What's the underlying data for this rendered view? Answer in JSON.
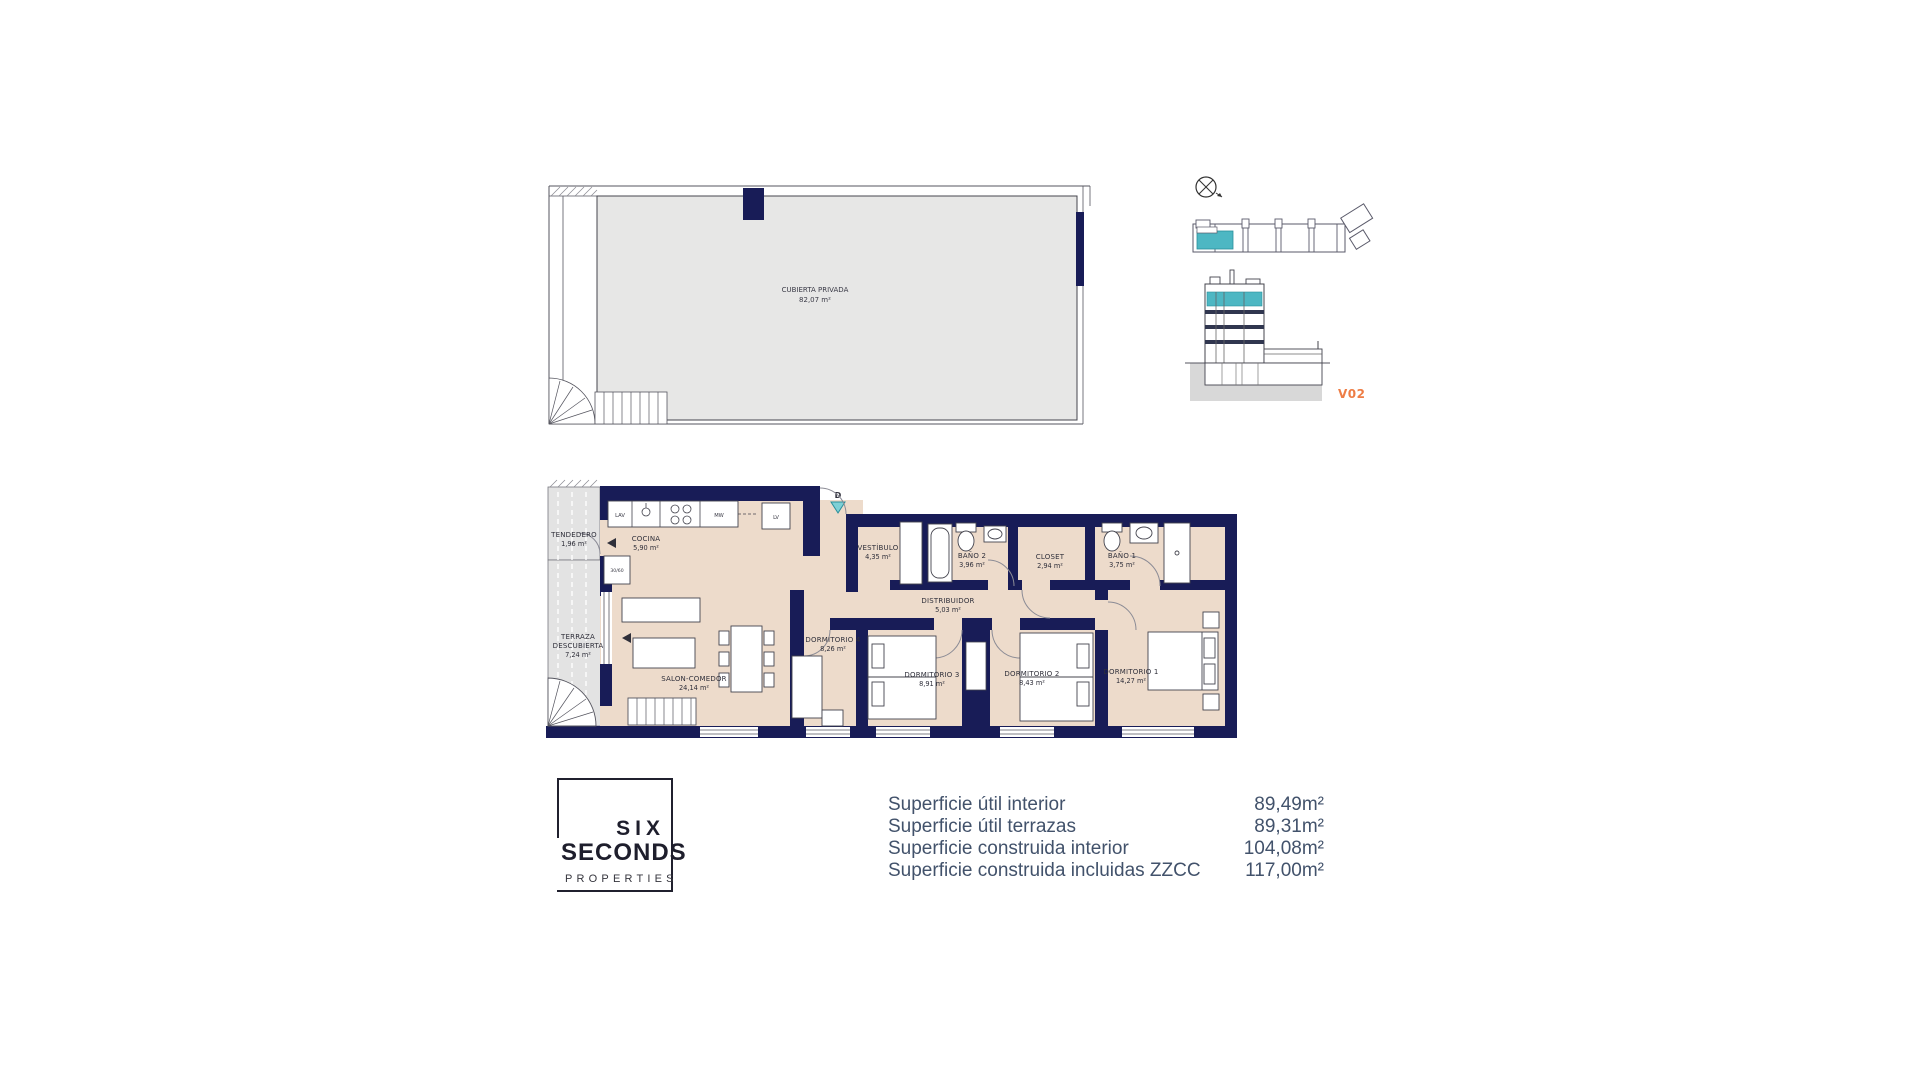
{
  "colors": {
    "wall_navy": "#181c57",
    "floor_beige": "#eddbcb",
    "terrace_gray": "#e3e3e3",
    "roof_gray": "#e7e7e6",
    "accent_teal": "#4db7c3",
    "accent_teal_light": "#7ed0d6",
    "accent_orange": "#ee7d45",
    "table_text": "#42526b",
    "plan_text": "#2f2f3a"
  },
  "roof_plan": {
    "label": "CUBIERTA PRIVADA",
    "area": "82,07 m²"
  },
  "locator": {
    "unit_label": "V02"
  },
  "floor_plan": {
    "entrance_marker": "D",
    "column_label": "30/60",
    "kitchen_appliances": [
      {
        "label": "LAV"
      },
      {
        "label": "MW"
      },
      {
        "label": "LV"
      }
    ],
    "rooms": [
      {
        "name": "TENDEDERO",
        "area": "1,96 m²"
      },
      {
        "name": "COCINA",
        "area": "5,90 m²"
      },
      {
        "name": "TERRAZA",
        "name2": "DESCUBIERTA",
        "area": "7,24 m²"
      },
      {
        "name": "SALON-COMEDOR",
        "area": "24,14 m²"
      },
      {
        "name": "VESTÍBULO",
        "area": "4,35 m²"
      },
      {
        "name": "BAÑO 2",
        "area": "3,96 m²"
      },
      {
        "name": "CLOSET",
        "area": "2,94 m²"
      },
      {
        "name": "BAÑO 1",
        "area": "3,75 m²"
      },
      {
        "name": "DISTRIBUIDOR",
        "area": "5,03 m²"
      },
      {
        "name": "DORMITORIO 4",
        "area": "8,26 m²"
      },
      {
        "name": "DORMITORIO 3",
        "area": "8,91 m²"
      },
      {
        "name": "DORMITORIO 2",
        "area": "8,43 m²"
      },
      {
        "name": "DORMITORIO 1",
        "area": "14,27 m²"
      }
    ]
  },
  "logo": {
    "line1": "SIX",
    "line2": "SECONDS",
    "line3": "PROPERTIES"
  },
  "areas_table": {
    "rows": [
      {
        "label": "Superficie útil interior",
        "value": "89,49m²"
      },
      {
        "label": "Superficie útil terrazas",
        "value": "89,31m²"
      },
      {
        "label": "Superficie construida interior",
        "value": "104,08m²"
      },
      {
        "label": "Superficie construida incluidas ZZCC",
        "value": "117,00m²"
      }
    ]
  }
}
